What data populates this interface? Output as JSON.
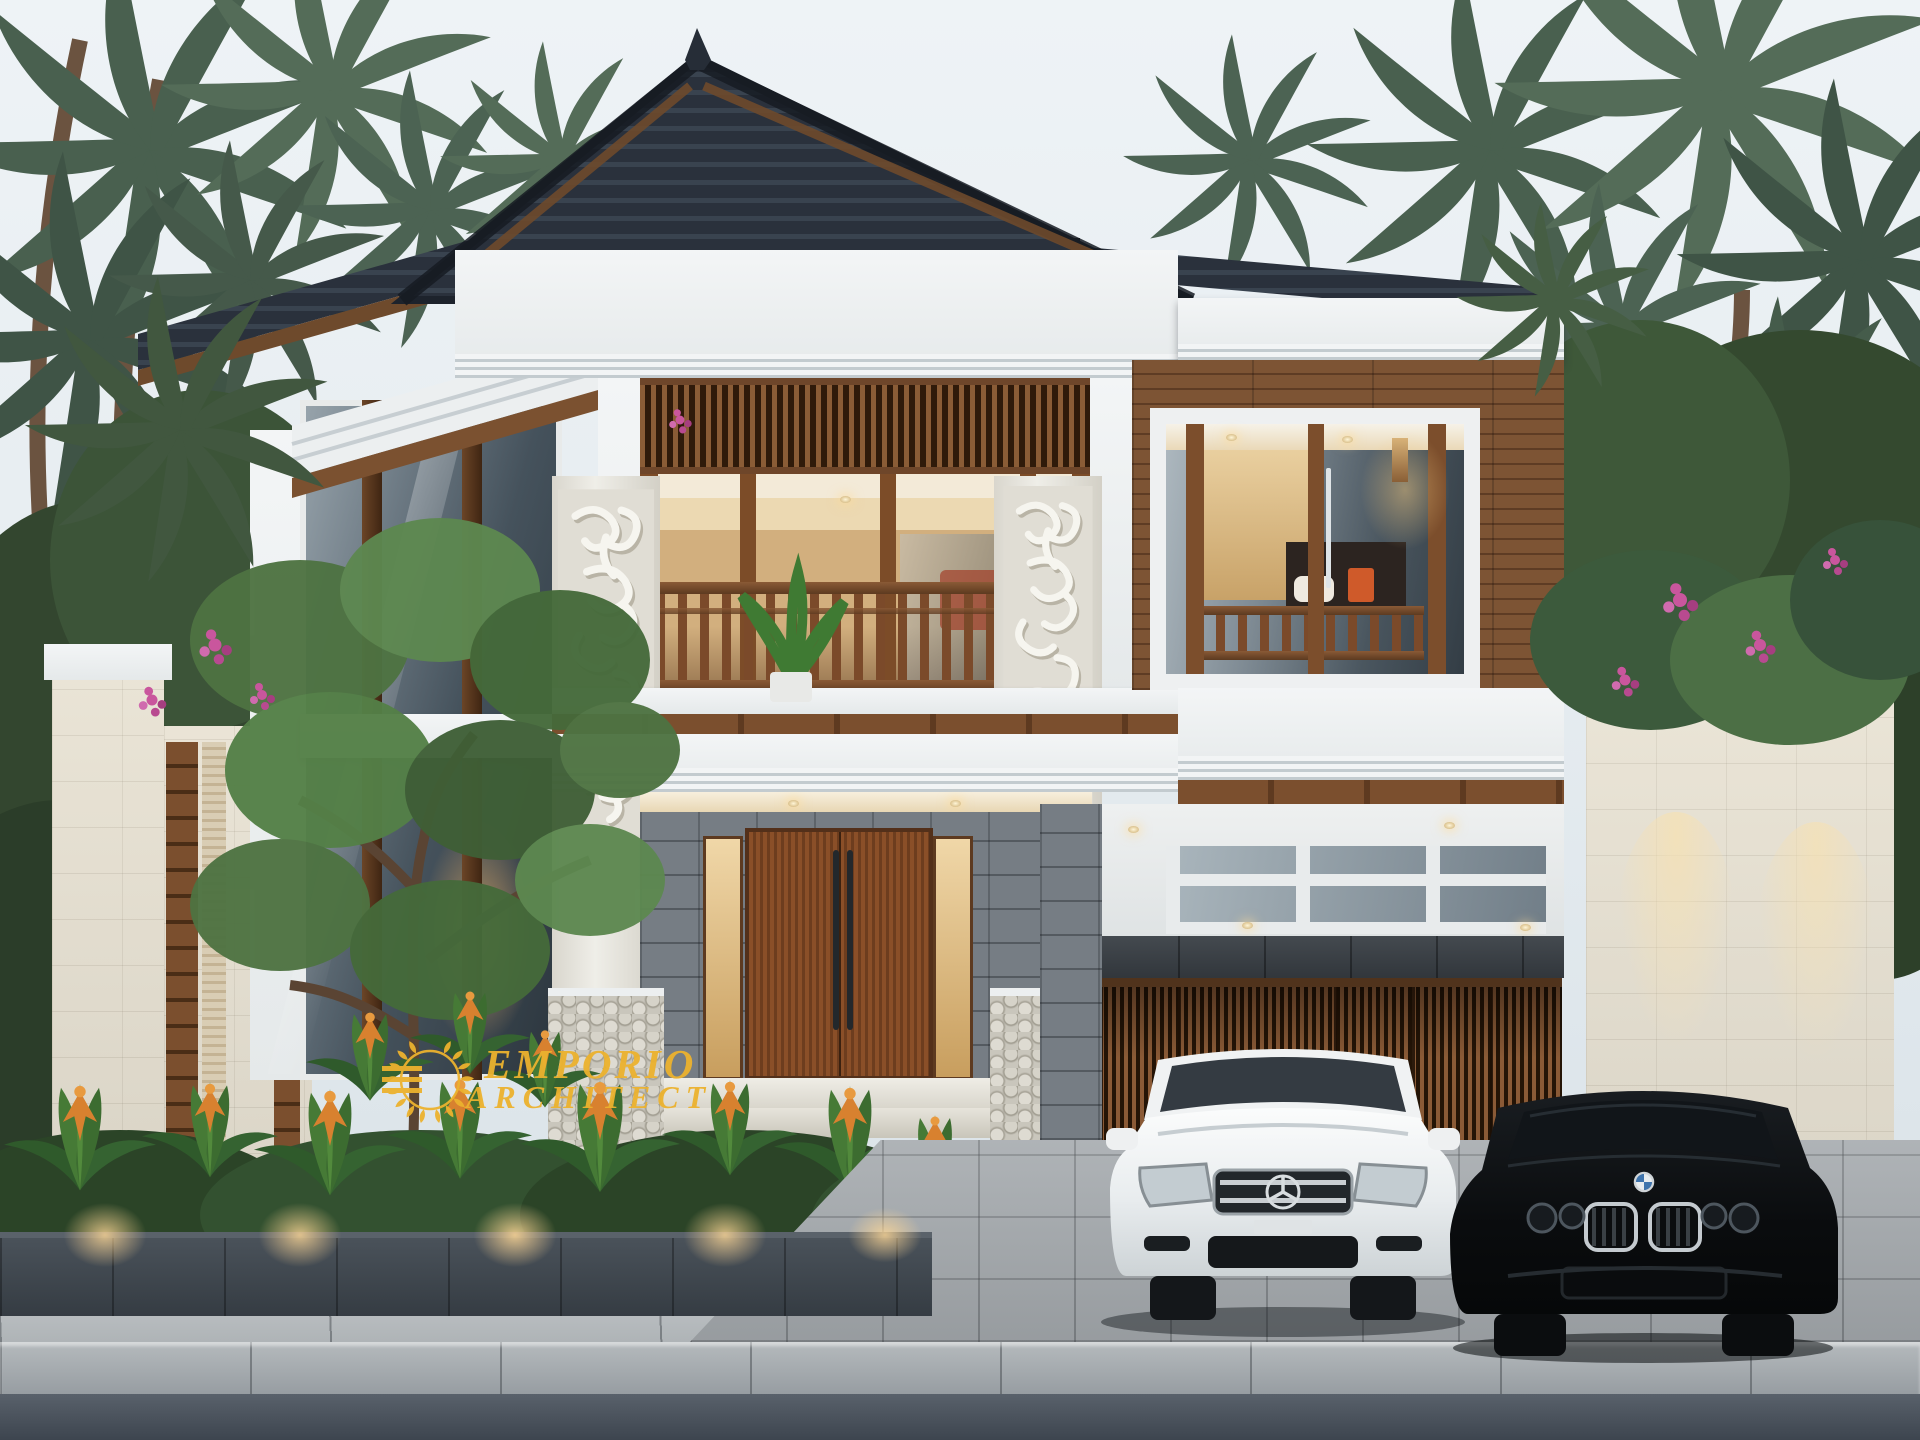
{
  "scene": {
    "type": "3D architectural exterior rendering",
    "subject": "Two-storey modern tropical (Balinese style) villa with double carport",
    "time": "dusk",
    "environment": "Coconut palm canopy and tropical garden surround the house; planter bed, paved driveway, sidewalk, curb and asphalt street in the foreground"
  },
  "watermark": {
    "line1": "EMPORIO",
    "line2": "ARCHITECT",
    "logo": "gold laurel wreath with E monogram",
    "color": "#ECB22E"
  },
  "house": {
    "storeys": 2,
    "roof": "dark blue-grey tiled hip roof with ridge finial and layered white cornices",
    "materials": [
      "white painted concrete",
      "teak wood panels and slats",
      "cream limestone tiles",
      "grey andesite stone",
      "clear glass"
    ],
    "features": [
      "two-storey glass curtain wall on left wing",
      "timber slat clerestory screen above balcony",
      "central balcony with timber railing and potted plant",
      "Balinese carved white stone relief pillars",
      "fish-scale carved pillar bases",
      "double timber entrance door with long black pull handles",
      "warm recessed soffit downlights",
      "right wing bedroom window with timber sliding frames",
      "carport with skylight grid and timber slat garage doors",
      "cream stone boundary wall with timber slat inserts"
    ]
  },
  "vehicles": [
    {
      "name": "white-sedan",
      "badge": "three-pointed-star",
      "body_color": "#F1F3F4"
    },
    {
      "name": "black-coupe",
      "badge": "blue-white-roundel",
      "body_color": "#0B0D10"
    }
  ],
  "landscape": [
    "coconut palm canopy left and right",
    "ornamental tree in front of glass wall",
    "bromeliads with orange flowers in street planter",
    "pink bougainvillea accents",
    "bird of paradise plants at fence"
  ],
  "lighting": [
    "warm interior glow",
    "soffit downlights",
    "wall washer lights on side wall",
    "planter uplights",
    "wall sconce on timber wall"
  ],
  "palette": {
    "sky": "#E7EDF1",
    "roof": "#2A313C",
    "roof_ridge": "#39434F",
    "fascia_white": "#EDF0F1",
    "wood_dark": "#3E2614",
    "wood_mid": "#7B4F2E",
    "wood_light": "#9A6A42",
    "glass_cool": "#5E6C78",
    "glass_dark": "#2E3A44",
    "interior_warm": "#E8C089",
    "stone_cream": "#EAE4D5",
    "stone_grey": "#7A8188",
    "stone_charcoal": "#3C4249",
    "leaf_dark": "#43584B",
    "leaf_mid": "#527046",
    "leaf_bright": "#6C9455",
    "flower_orange": "#D8812F",
    "flower_pink": "#C9569D",
    "paver": "#A6ABAF",
    "sidewalk": "#B7BCBF",
    "curb": "#A3A9AD",
    "asphalt": "#4E565F",
    "gold": "#ECB22E",
    "warm_light": "#F5C97E"
  }
}
